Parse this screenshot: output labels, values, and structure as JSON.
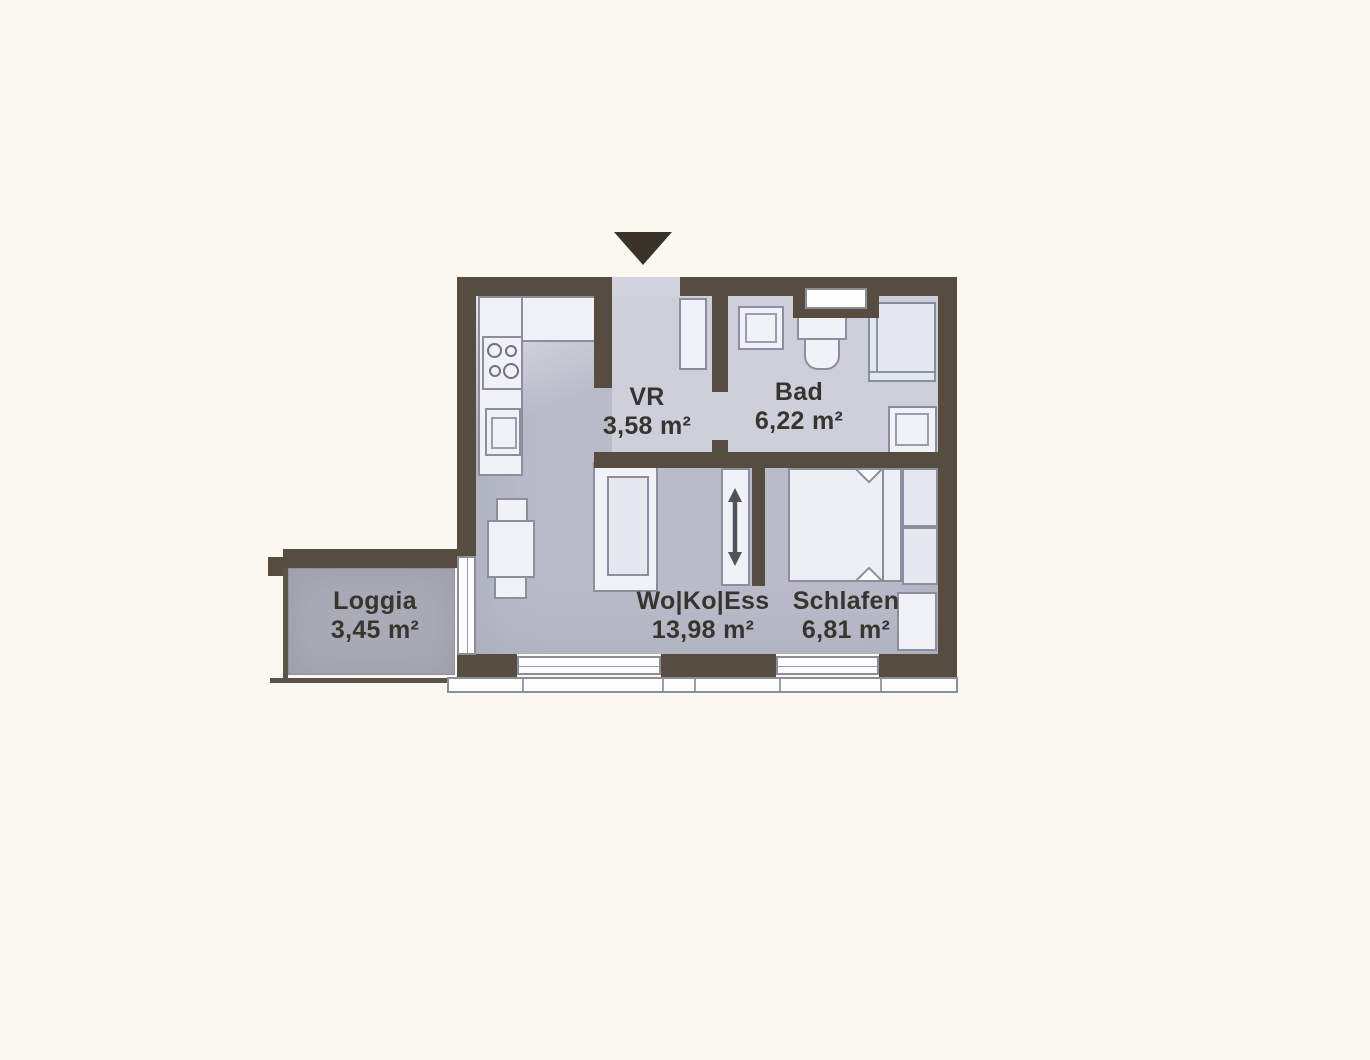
{
  "plan": {
    "type": "apartment-floor-plan",
    "entrance_marker": "entrance-arrow",
    "rooms": [
      {
        "id": "vr",
        "name": "VR",
        "area": "3,58 m²"
      },
      {
        "id": "bad",
        "name": "Bad",
        "area": "6,22 m²"
      },
      {
        "id": "wo-ko-ess",
        "name": "Wo|Ko|Ess",
        "area": "13,98 m²"
      },
      {
        "id": "schlafen",
        "name": "Schlafen",
        "area": "6,81 m²"
      },
      {
        "id": "loggia",
        "name": "Loggia",
        "area": "3,45 m²"
      }
    ],
    "colors": {
      "bg": "#fbf8f1",
      "wall": "#564c40",
      "wall-dark": "#39332a",
      "floor-main": "#b9bbc9",
      "floor-light": "#cdcfda",
      "floor-loggia": "#a9abb7",
      "furniture-fill": "#f1f2f7",
      "furniture-line": "#8b8e9e",
      "window-line": "#8b8e99",
      "text": "#38352f"
    }
  }
}
